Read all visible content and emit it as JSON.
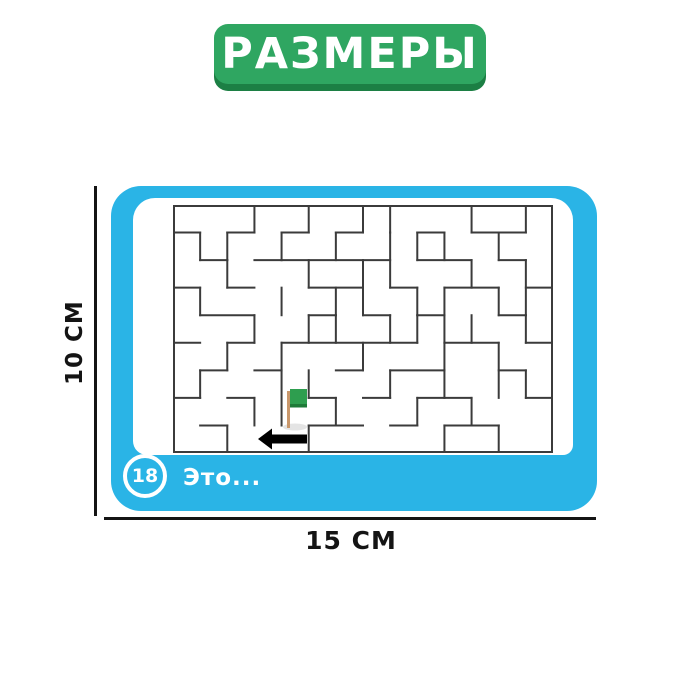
{
  "badge": {
    "label": "РАЗМЕРЫ",
    "fill_color": "#2FA661",
    "edge_color": "#1C7F44",
    "text_color": "#FFFFFF"
  },
  "dimensions": {
    "height_label": "10 CM",
    "width_label": "15 CM",
    "line_color": "#141414"
  },
  "card": {
    "background_color": "#2AB4E6",
    "panel_color": "#FFFFFF",
    "number_badge": "18",
    "caption": "Это..."
  },
  "maze": {
    "grid": {
      "cols": 14,
      "rows": 9,
      "width": 380,
      "height": 248
    },
    "wall_color": "#3B3B3B",
    "wall_width": 2,
    "h_walls": [
      [
        1,
        0,
        1
      ],
      [
        1,
        2,
        3
      ],
      [
        1,
        4,
        5
      ],
      [
        1,
        6,
        7
      ],
      [
        1,
        9,
        10
      ],
      [
        1,
        11,
        13
      ],
      [
        2,
        1,
        2
      ],
      [
        2,
        3,
        4
      ],
      [
        2,
        4,
        8
      ],
      [
        2,
        9,
        11
      ],
      [
        2,
        12,
        13
      ],
      [
        3,
        0,
        1
      ],
      [
        3,
        2,
        3
      ],
      [
        3,
        5,
        7
      ],
      [
        3,
        8,
        9
      ],
      [
        3,
        10,
        12
      ],
      [
        3,
        13,
        14
      ],
      [
        4,
        1,
        3
      ],
      [
        4,
        5,
        6
      ],
      [
        4,
        7,
        8
      ],
      [
        4,
        9,
        10
      ],
      [
        4,
        12,
        13
      ],
      [
        5,
        0,
        1
      ],
      [
        5,
        2,
        3
      ],
      [
        5,
        4,
        9
      ],
      [
        5,
        10,
        12
      ],
      [
        5,
        13,
        14
      ],
      [
        6,
        1,
        2
      ],
      [
        6,
        3,
        4
      ],
      [
        6,
        6,
        7
      ],
      [
        6,
        8,
        10
      ],
      [
        6,
        12,
        13
      ],
      [
        7,
        0,
        1
      ],
      [
        7,
        2,
        3
      ],
      [
        7,
        5,
        6
      ],
      [
        7,
        7,
        8
      ],
      [
        7,
        9,
        11
      ],
      [
        7,
        13,
        14
      ],
      [
        8,
        1,
        2
      ],
      [
        8,
        5,
        7
      ],
      [
        8,
        8,
        9
      ],
      [
        8,
        10,
        12
      ]
    ],
    "v_walls": [
      [
        3,
        0,
        1
      ],
      [
        5,
        0,
        1
      ],
      [
        7,
        0,
        1
      ],
      [
        8,
        0,
        1
      ],
      [
        11,
        0,
        1
      ],
      [
        13,
        0,
        1
      ],
      [
        1,
        1,
        2
      ],
      [
        2,
        1,
        2
      ],
      [
        4,
        1,
        2
      ],
      [
        6,
        1,
        2
      ],
      [
        9,
        1,
        2
      ],
      [
        10,
        1,
        2
      ],
      [
        12,
        1,
        2
      ],
      [
        8,
        1,
        3
      ],
      [
        2,
        2,
        3
      ],
      [
        5,
        2,
        3
      ],
      [
        7,
        2,
        4
      ],
      [
        11,
        2,
        3
      ],
      [
        13,
        2,
        4
      ],
      [
        1,
        3,
        4
      ],
      [
        4,
        3,
        4
      ],
      [
        6,
        3,
        4
      ],
      [
        9,
        3,
        4
      ],
      [
        10,
        3,
        5
      ],
      [
        12,
        3,
        4
      ],
      [
        3,
        4,
        5
      ],
      [
        5,
        4,
        5
      ],
      [
        6,
        4,
        5
      ],
      [
        8,
        4,
        5
      ],
      [
        9,
        4,
        5
      ],
      [
        11,
        4,
        5
      ],
      [
        13,
        4,
        5
      ],
      [
        2,
        5,
        6
      ],
      [
        4,
        5,
        8
      ],
      [
        7,
        5,
        6
      ],
      [
        10,
        5,
        6
      ],
      [
        12,
        5,
        7
      ],
      [
        1,
        6,
        7
      ],
      [
        5,
        6,
        7
      ],
      [
        8,
        6,
        7
      ],
      [
        10,
        6,
        7
      ],
      [
        13,
        6,
        7
      ],
      [
        3,
        7,
        8
      ],
      [
        6,
        7,
        8
      ],
      [
        9,
        7,
        8
      ],
      [
        11,
        7,
        8
      ],
      [
        2,
        8,
        9
      ],
      [
        5,
        8,
        9
      ],
      [
        10,
        8,
        9
      ],
      [
        12,
        8,
        9
      ]
    ],
    "flag": {
      "flag_color": "#2E9E4F",
      "flag_edge_color": "#1E7A38",
      "pole_color": "#C9976B",
      "shadow_color": "#DDDDDD",
      "x": 113,
      "y": 184
    },
    "arrow": {
      "color": "#000000",
      "tip_x": 85,
      "tail_x": 134,
      "center_y": 234,
      "head_half_height": 10.5,
      "body_half_height": 4.5
    }
  }
}
